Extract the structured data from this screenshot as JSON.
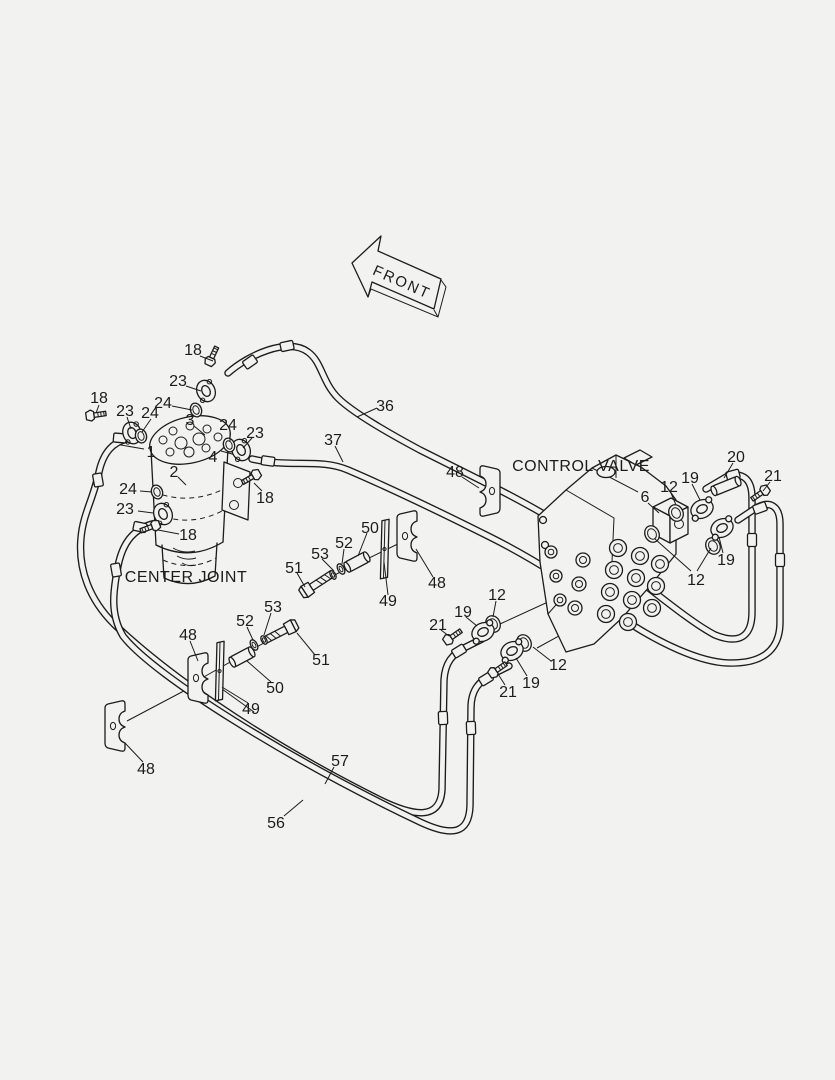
{
  "page": {
    "background": "#f2f2f0",
    "ink": "#1c1c1c"
  },
  "labels": {
    "front": "FRONT",
    "center_joint": "CENTER JOINT",
    "control_valve": "CONTROL VALVE"
  },
  "callouts": [
    {
      "text": "18"
    },
    {
      "text": "23"
    },
    {
      "text": "24"
    },
    {
      "text": "3"
    },
    {
      "text": "18"
    },
    {
      "text": "23"
    },
    {
      "text": "24"
    },
    {
      "text": "1"
    },
    {
      "text": "24"
    },
    {
      "text": "23"
    },
    {
      "text": "4"
    },
    {
      "text": "2"
    },
    {
      "text": "24"
    },
    {
      "text": "23"
    },
    {
      "text": "18"
    },
    {
      "text": "18"
    },
    {
      "text": "36"
    },
    {
      "text": "37"
    },
    {
      "text": "48"
    },
    {
      "text": "50"
    },
    {
      "text": "52"
    },
    {
      "text": "53"
    },
    {
      "text": "51"
    },
    {
      "text": "49"
    },
    {
      "text": "48"
    },
    {
      "text": "53"
    },
    {
      "text": "52"
    },
    {
      "text": "51"
    },
    {
      "text": "50"
    },
    {
      "text": "49"
    },
    {
      "text": "48"
    },
    {
      "text": "48"
    },
    {
      "text": "57"
    },
    {
      "text": "56"
    },
    {
      "text": "6"
    },
    {
      "text": "12"
    },
    {
      "text": "19"
    },
    {
      "text": "20"
    },
    {
      "text": "21"
    },
    {
      "text": "19"
    },
    {
      "text": "12"
    },
    {
      "text": "12"
    },
    {
      "text": "19"
    },
    {
      "text": "21"
    },
    {
      "text": "12"
    },
    {
      "text": "19"
    },
    {
      "text": "21"
    }
  ]
}
